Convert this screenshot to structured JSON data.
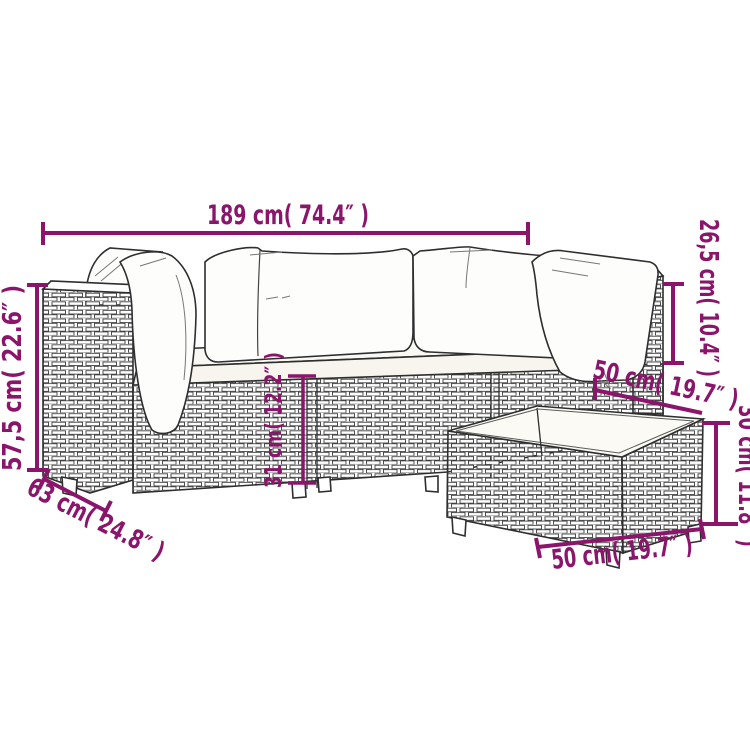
{
  "diagram": {
    "title": "garden-lounge-set-dimension-diagram",
    "accent_color": "#8a156b",
    "outline_color": "#2e2e2e",
    "dimensions": {
      "overall_width": "189 cm( 74.4″ )",
      "backrest_height": "26,5 cm( 10.4″ )",
      "overall_height": "57,5 cm( 22.6″ )",
      "base_height": "31 cm( 12.2″ )",
      "table_depth": "50 cm( 19.7″ )",
      "table_height": "30 cm( 11.8″ )",
      "seat_depth": "63 cm( 24.8″ )",
      "table_width": "50 cm( 19.7″ )"
    }
  }
}
